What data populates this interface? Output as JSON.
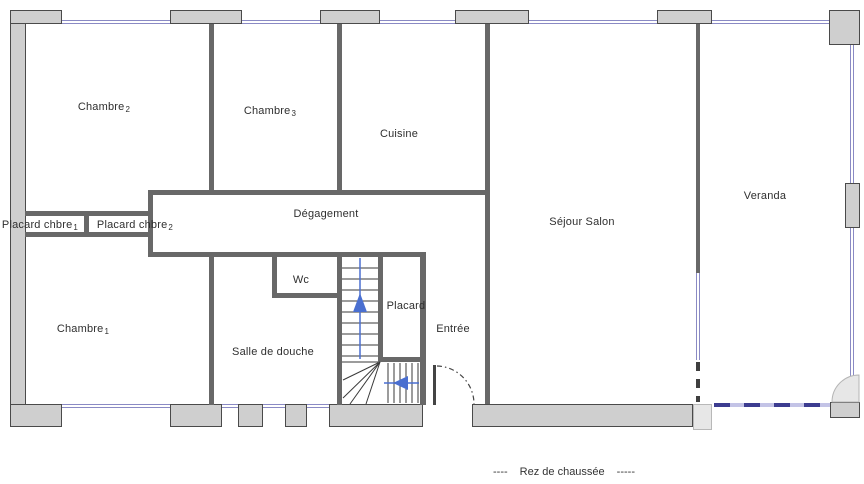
{
  "plan_title": "Rez de chaussée",
  "footer": {
    "left_dashes": "----",
    "label": "Rez de chaussée",
    "right_dashes": "-----"
  },
  "rooms": {
    "chambre2": {
      "name": "Chambre",
      "sub": "2"
    },
    "chambre3": {
      "name": "Chambre",
      "sub": "3"
    },
    "cuisine": {
      "name": "Cuisine"
    },
    "sejour_salon": {
      "name": "Séjour Salon"
    },
    "veranda": {
      "name": "Veranda"
    },
    "degagement": {
      "name": "Dégagement"
    },
    "placard_chbre1": {
      "name": "Placard chbre",
      "sub": "1"
    },
    "placard_chbre2": {
      "name": "Placard chbre",
      "sub": "2"
    },
    "chambre1": {
      "name": "Chambre",
      "sub": "1"
    },
    "salle_de_douche": {
      "name": "Salle de douche"
    },
    "wc": {
      "name": "Wc"
    },
    "placard": {
      "name": "Placard"
    },
    "entree": {
      "name": "Entrée"
    }
  },
  "icons": {
    "stairs_up_arrow": "triangle-up",
    "stairs_left_arrow": "triangle-left"
  },
  "colors": {
    "wall-fill": "#cfcfcf",
    "wall-edge": "#4a4a4a",
    "inner-wall": "#686868",
    "window-blue": "#8a8ac4",
    "bay-dash-dark": "#3c3c90",
    "bay-dash-light": "#c3c3e6",
    "arrow-blue": "#4a6fd0",
    "light-block": "#e7e7e7",
    "text": "#2f2f2f"
  }
}
